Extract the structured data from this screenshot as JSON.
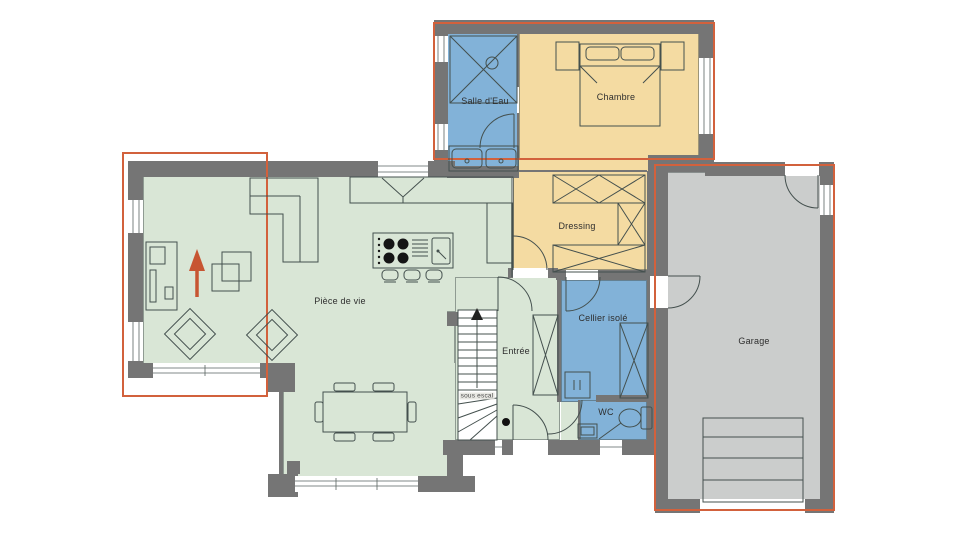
{
  "plan": {
    "rooms": [
      {
        "id": "piece-de-vie",
        "label": "Pièce de vie"
      },
      {
        "id": "salle-d-eau",
        "label": "Salle d'Eau"
      },
      {
        "id": "chambre",
        "label": "Chambre"
      },
      {
        "id": "dressing",
        "label": "Dressing"
      },
      {
        "id": "entree",
        "label": "Entrée"
      },
      {
        "id": "cellier-isole",
        "label": "Cellier isolé"
      },
      {
        "id": "wc",
        "label": "WC"
      },
      {
        "id": "garage",
        "label": "Garage"
      }
    ],
    "stair_note": "sous escal",
    "colors": {
      "living": "#d9e6d6",
      "bedroom_zone": "#f4dba2",
      "wet_zone": "#82b2d8",
      "garage_floor": "#cbcdcc",
      "walls": "#757575",
      "envelope_outline": "#d2613c",
      "north_arrow": "#c75532"
    }
  }
}
